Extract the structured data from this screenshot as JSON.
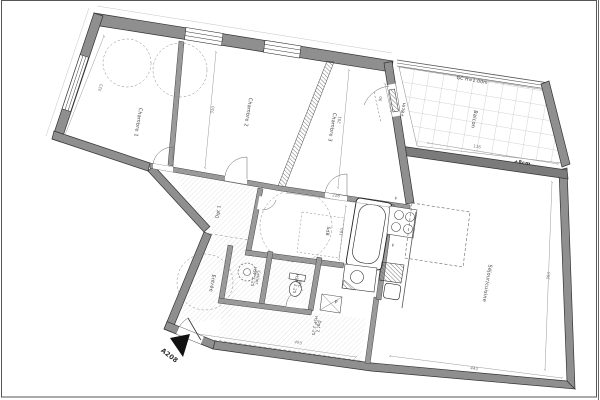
{
  "floorplan": {
    "sheet": {
      "unit": "A208",
      "type": "architectural-floor-plan"
    },
    "colors": {
      "paper": "#ffffff",
      "wall_fill": "#8f8f8f",
      "wall_dark": "#7b7b7b",
      "ink": "#3d3d3d",
      "dim_line": "#9a9a9a",
      "floor_hatch": "#cfcfcf"
    },
    "rooms": [
      {
        "label": "Chambre 1",
        "x": 137,
        "y": 122,
        "rot": 99.5,
        "fs": 5
      },
      {
        "label": "Chambre 2",
        "x": 247,
        "y": 112,
        "rot": 99.5,
        "fs": 5
      },
      {
        "label": "Chambre 3",
        "x": 331,
        "y": 127,
        "rot": 99.5,
        "fs": 5
      },
      {
        "label": "Balcon",
        "x": 473,
        "y": 119,
        "rot": 99.5,
        "fs": 5
      },
      {
        "label": "Séjour/cuisine",
        "x": 486,
        "y": 283,
        "rot": 99.5,
        "fs": 5
      },
      {
        "label": "Entrée",
        "x": 211,
        "y": 283,
        "rot": 99.5,
        "fs": 5
      },
      {
        "label": "Dgt 1",
        "x": 219,
        "y": 212,
        "rot": -80.5,
        "fs": 4.5
      },
      {
        "label": "SdB",
        "x": 327,
        "y": 231,
        "rot": 99.5,
        "fs": 4.5
      },
      {
        "label": "Cellier\nHSP 2.25",
        "x": 255,
        "y": 277,
        "rot": 99.5,
        "fs": 4
      },
      {
        "label": "WC\nHSP 2.25",
        "x": 297,
        "y": 284,
        "rot": 99.5,
        "fs": 4
      },
      {
        "label": "Dgt 2\nHSP 2.25",
        "x": 316,
        "y": 326,
        "rot": 99.5,
        "fs": 4
      }
    ],
    "annotations": [
      {
        "text": "GC  H=1.00m",
        "x": 472,
        "y": 81,
        "rot": 9.5,
        "fs": 4.5
      },
      {
        "text": "+8cm",
        "x": 404,
        "y": 110,
        "rot": -80.5,
        "fs": 4.5
      },
      {
        "text": "+8cm",
        "x": 522,
        "y": 164,
        "rot": 9.5,
        "fs": 5,
        "bold": true
      },
      {
        "text": "A208",
        "x": 169,
        "y": 356,
        "rot": 38,
        "fs": 6.5,
        "bold": true
      },
      {
        "text": "P",
        "x": 336,
        "y": 303,
        "rot": 9.5,
        "fs": 4.5
      },
      {
        "text": "F",
        "x": 396,
        "y": 199,
        "rot": 9.5,
        "fs": 4
      },
      {
        "text": "F",
        "x": 393,
        "y": 246,
        "rot": 9.5,
        "fs": 4
      }
    ],
    "dimensions": [
      {
        "text": "323",
        "x": 101,
        "y": 88,
        "rot": -75
      },
      {
        "text": "310",
        "x": 213,
        "y": 110,
        "rot": -80.5
      },
      {
        "text": "281",
        "x": 340,
        "y": 120,
        "rot": -80.5
      },
      {
        "text": "90",
        "x": 381,
        "y": 99,
        "rot": -80.5
      },
      {
        "text": "116",
        "x": 477,
        "y": 147,
        "rot": 9.5
      },
      {
        "text": "228",
        "x": 336,
        "y": 196,
        "rot": 9.5
      },
      {
        "text": "160",
        "x": 342,
        "y": 232,
        "rot": -80.5
      },
      {
        "text": "393",
        "x": 549,
        "y": 276,
        "rot": -80.5
      },
      {
        "text": "443",
        "x": 474,
        "y": 369,
        "rot": 9.5
      },
      {
        "text": "493",
        "x": 298,
        "y": 343,
        "rot": 12
      }
    ]
  }
}
